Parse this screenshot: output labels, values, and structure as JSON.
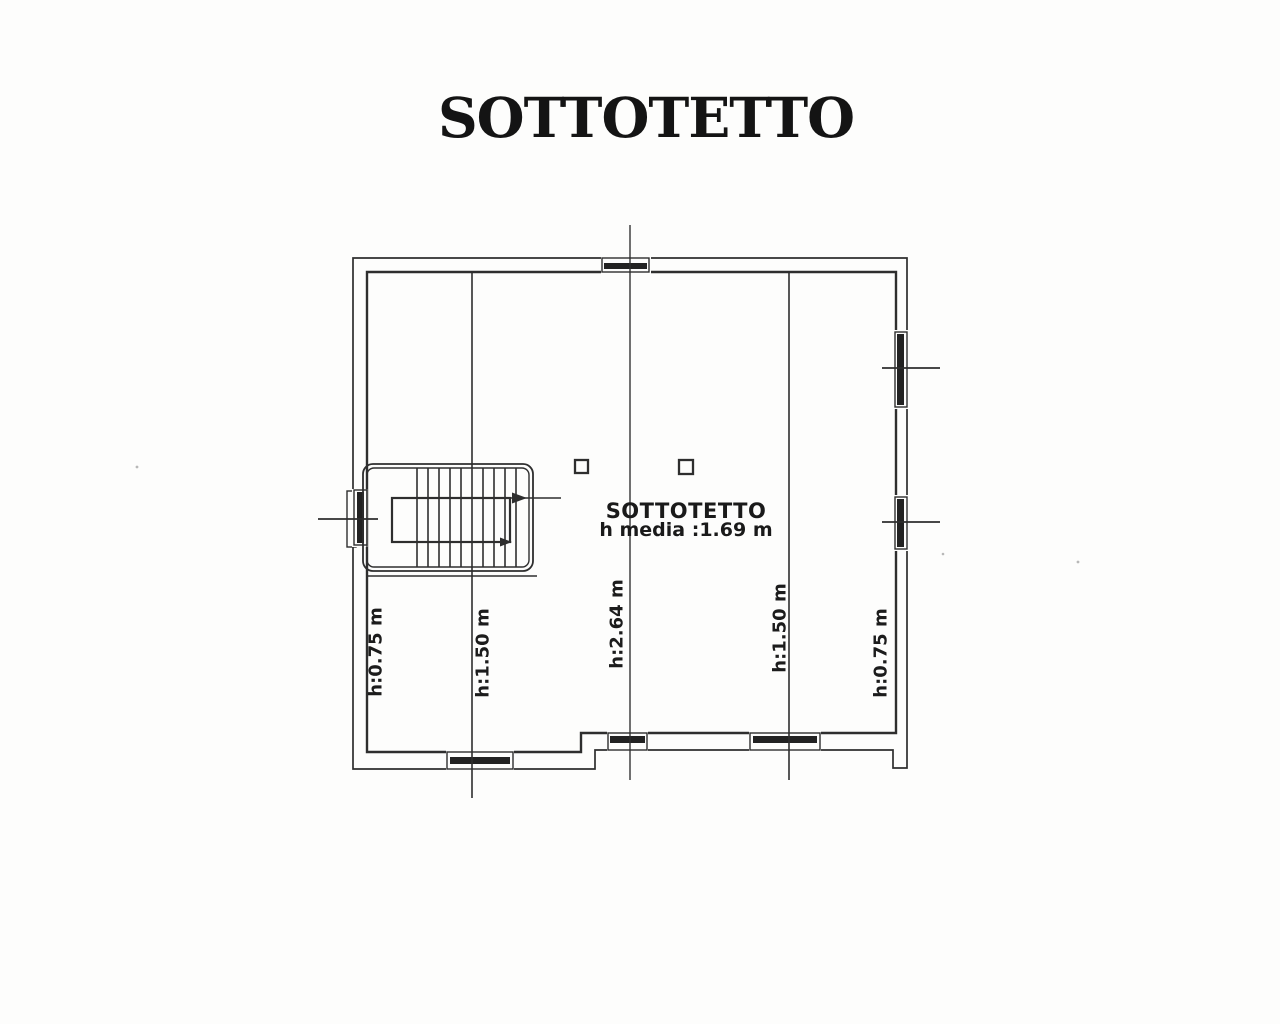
{
  "title": "SOTTOTETTO",
  "room_label": {
    "name": "SOTTOTETTO",
    "avg_height": "h media :1.69 m"
  },
  "height_labels": [
    {
      "id": "left-eaves",
      "text": "h:0.75 m"
    },
    {
      "id": "left-mid",
      "text": "h:1.50 m"
    },
    {
      "id": "ridge",
      "text": "h:2.64 m"
    },
    {
      "id": "right-mid",
      "text": "h:1.50 m"
    },
    {
      "id": "right-eaves",
      "text": "h:0.75 m"
    }
  ],
  "colors": {
    "ink": "#2e2e2e",
    "paper": "#fdfdfc"
  }
}
